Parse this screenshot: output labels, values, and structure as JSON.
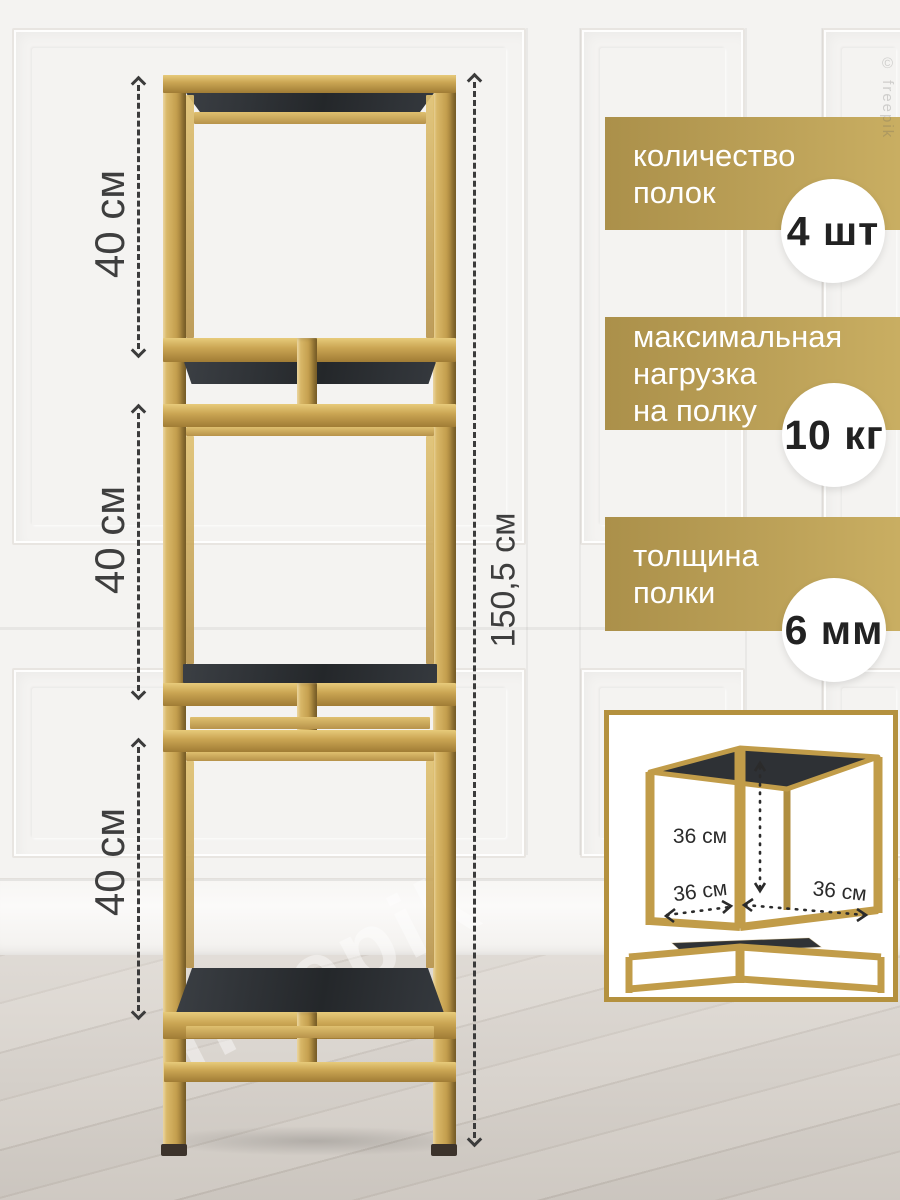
{
  "dimensions": {
    "section1": "40 см",
    "section2": "40 см",
    "section3": "40 см",
    "total_height": "150,5 см"
  },
  "badges": [
    {
      "lines": [
        "количество",
        "полок"
      ],
      "value": "4 шт"
    },
    {
      "lines": [
        "максимальная",
        "нагрузка",
        "на полку"
      ],
      "value": "10 кг"
    },
    {
      "lines": [
        "толщина",
        "полки"
      ],
      "value": "6 мм"
    }
  ],
  "inset": {
    "dim_height": "36 см",
    "dim_depth": "36 см",
    "dim_width": "36 см"
  },
  "watermark": {
    "floor_text": "freepik",
    "corner_text": "© freepik"
  },
  "colors": {
    "badge_gold_left": "#ab904a",
    "badge_gold_right": "#c9ae62",
    "frame_gold": "#c4a14f",
    "shelf_dark": "#303338",
    "wall": "#f4f3f1",
    "floor": "#d6d0c9",
    "dim_text": "#3e3e3e"
  }
}
